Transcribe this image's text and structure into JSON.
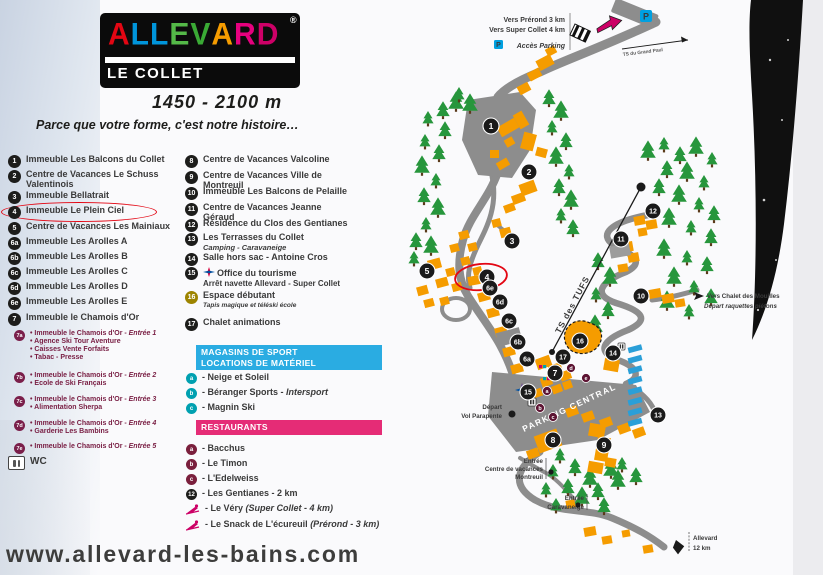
{
  "logo": {
    "brand": "ALLEVARD",
    "registered": "®",
    "sub": "LE COLLET"
  },
  "altitude": "1450 - 2100 m",
  "tagline": "Parce que votre forme, c'est notre histoire…",
  "website": "www.allevard-les-bains.com",
  "legend": {
    "column1": [
      {
        "badge": "1",
        "label": "Immeuble Les Balcons du Collet"
      },
      {
        "badge": "2",
        "label": "Centre de Vacances Le Schuss Valentinois"
      },
      {
        "badge": "3",
        "label": "Immeuble Bellatrait"
      },
      {
        "badge": "4",
        "label": "Immeuble Le Plein Ciel",
        "highlighted": true
      },
      {
        "badge": "5",
        "label": "Centre de Vacances Les Mainiaux"
      },
      {
        "badge": "6a",
        "label": "Immeuble Les Arolles A"
      },
      {
        "badge": "6b",
        "label": "Immeuble Les Arolles B"
      },
      {
        "badge": "6c",
        "label": "Immeuble Les Arolles C"
      },
      {
        "badge": "6d",
        "label": "Immeuble Les Arolles D"
      },
      {
        "badge": "6e",
        "label": "Immeuble Les Arolles E"
      },
      {
        "badge": "7",
        "label": "Immeuble le Chamois d'Or"
      }
    ],
    "column1_sub": [
      {
        "badge": "7a",
        "lines": [
          {
            "t": "Immeuble le Chamois d'Or - ",
            "i": "Entrée 1"
          },
          {
            "t": "Agence Ski Tour Aventure"
          },
          {
            "t": "Caisses Vente Forfaits"
          },
          {
            "t": "Tabac - Presse"
          }
        ]
      },
      {
        "badge": "7b",
        "lines": [
          {
            "t": "Immeuble le Chamois d'Or - ",
            "i": "Entrée 2"
          },
          {
            "t": "Ecole de Ski Français"
          }
        ]
      },
      {
        "badge": "7c",
        "lines": [
          {
            "t": "Immeuble le Chamois d'Or - ",
            "i": "Entrée 3"
          },
          {
            "t": "Alimentation Sherpa"
          }
        ]
      },
      {
        "badge": "7d",
        "lines": [
          {
            "t": "Immeuble le Chamois d'Or - ",
            "i": "Entrée 4"
          },
          {
            "t": "Garderie Les Bambins"
          }
        ]
      },
      {
        "badge": "7e",
        "lines": [
          {
            "t": "Immeuble le Chamois d'Or - ",
            "i": "Entrée 5"
          }
        ]
      }
    ],
    "wc_label": "WC",
    "column2": [
      {
        "badge": "8",
        "label": "Centre de Vacances Valcoline"
      },
      {
        "badge": "9",
        "label": "Centre de Vacances Ville de Montreuil"
      },
      {
        "badge": "10",
        "label": "Immeuble Les Balcons de Pelaille"
      },
      {
        "badge": "11",
        "label": "Centre de Vacances Jeanne Géraud"
      },
      {
        "badge": "12",
        "label": "Résidence du Clos des Gentianes"
      },
      {
        "badge": "13",
        "label": "Les Terrasses du Collet",
        "sub": "Camping - Caravaneige",
        "sub_italic": true
      },
      {
        "badge": "14",
        "label": "Salle hors sac - Antoine Cros"
      },
      {
        "badge": "15",
        "label": "Office du tourisme",
        "icon": "compass",
        "sub": "Arrêt navette Allevard - Super Collet",
        "sub_italic": false
      },
      {
        "badge": "16",
        "badge_style": "olive",
        "label": "Espace débutant",
        "sub": "Tapis magique et téléski école",
        "sub_italic": true,
        "sub_small": true
      },
      {
        "badge": "17",
        "label": "Chalet animations"
      }
    ]
  },
  "shops": {
    "header_line1": "MAGASINS DE SPORT",
    "header_line2": "LOCATIONS DE MATÉRIEL",
    "items": [
      {
        "badge": "a",
        "label": "- Neige et Soleil"
      },
      {
        "badge": "b",
        "label": "- Béranger Sports - ",
        "italic": "Intersport"
      },
      {
        "badge": "c",
        "label": "- Magnin Ski"
      }
    ]
  },
  "restaurants": {
    "header": "RESTAURANTS",
    "items": [
      {
        "badge": "a",
        "label": "- Bacchus"
      },
      {
        "badge": "b",
        "label": "- Le Timon"
      },
      {
        "badge": "c",
        "label": "- L'Edelweiss"
      },
      {
        "badge": "12",
        "badge_style": "black",
        "label": "- Les Gentianes - 2 km"
      },
      {
        "icon": "skier",
        "label": "- Le Véry ",
        "italic": "(Super Collet - 4 km)"
      },
      {
        "icon": "skier",
        "label": "- Le Snack de L'écureuil ",
        "italic": "(Prérond - 3 km)"
      }
    ]
  },
  "map": {
    "labels": {
      "vers_prerond": "Vers Prérond 3 km",
      "vers_super_collet": "Vers Super Collet 4 km",
      "acces_parking": "Accès Parking",
      "p_letter": "P",
      "ts_grand": "TS du Grand Paul",
      "ts_tufs": "TS des TUFS",
      "mouilles1": "Vers Chalet des Mouilles",
      "mouilles2": "Départ raquettes piétons",
      "parking_central": "PARKING CENTRAL",
      "depart1": "Départ",
      "depart2": "Vol Parapente",
      "entree1a": "Entrée",
      "entree1b": "Centre de vacances",
      "entree1c": "Montreuil",
      "entree2a": "Entrée",
      "entree2b": "Caravaneige",
      "allevard1": "Allevard",
      "allevard2": "12 km"
    },
    "markers": [
      {
        "id": "1",
        "x": 491,
        "y": 126
      },
      {
        "id": "2",
        "x": 529,
        "y": 172
      },
      {
        "id": "3",
        "x": 512,
        "y": 241
      },
      {
        "id": "4",
        "x": 487,
        "y": 277,
        "ring": true
      },
      {
        "id": "5",
        "x": 427,
        "y": 271
      },
      {
        "id": "6e",
        "x": 490,
        "y": 288
      },
      {
        "id": "6d",
        "x": 500,
        "y": 302
      },
      {
        "id": "6c",
        "x": 509,
        "y": 321
      },
      {
        "id": "6b",
        "x": 518,
        "y": 342
      },
      {
        "id": "6a",
        "x": 527,
        "y": 359
      },
      {
        "id": "7",
        "x": 555,
        "y": 373
      },
      {
        "id": "8",
        "x": 553,
        "y": 440
      },
      {
        "id": "9",
        "x": 604,
        "y": 445
      },
      {
        "id": "10",
        "x": 641,
        "y": 296
      },
      {
        "id": "11",
        "x": 621,
        "y": 239
      },
      {
        "id": "12",
        "x": 653,
        "y": 211
      },
      {
        "id": "13",
        "x": 658,
        "y": 415
      },
      {
        "id": "14",
        "x": 613,
        "y": 353
      },
      {
        "id": "15",
        "x": 528,
        "y": 392
      },
      {
        "id": "16",
        "x": 580,
        "y": 341
      },
      {
        "id": "17",
        "x": 563,
        "y": 357
      }
    ],
    "letter_markers": [
      {
        "id": "a",
        "x": 547,
        "y": 391
      },
      {
        "id": "b",
        "x": 540,
        "y": 408
      },
      {
        "id": "c",
        "x": 553,
        "y": 417
      },
      {
        "id": "d",
        "x": 571,
        "y": 368
      },
      {
        "id": "e",
        "x": 586,
        "y": 378
      }
    ]
  },
  "colors": {
    "building": "#f59c00",
    "road": "#8d8d8d",
    "tree": "#27963c",
    "accent_red": "#e30613",
    "shop_teal": "#00a0b0",
    "restaurant_maroon": "#7a1f3c",
    "header_blue": "#2aace2",
    "header_pink": "#e52c76",
    "parking_blue": "#00a0e0",
    "camping_blue": "#2a9fd8"
  }
}
